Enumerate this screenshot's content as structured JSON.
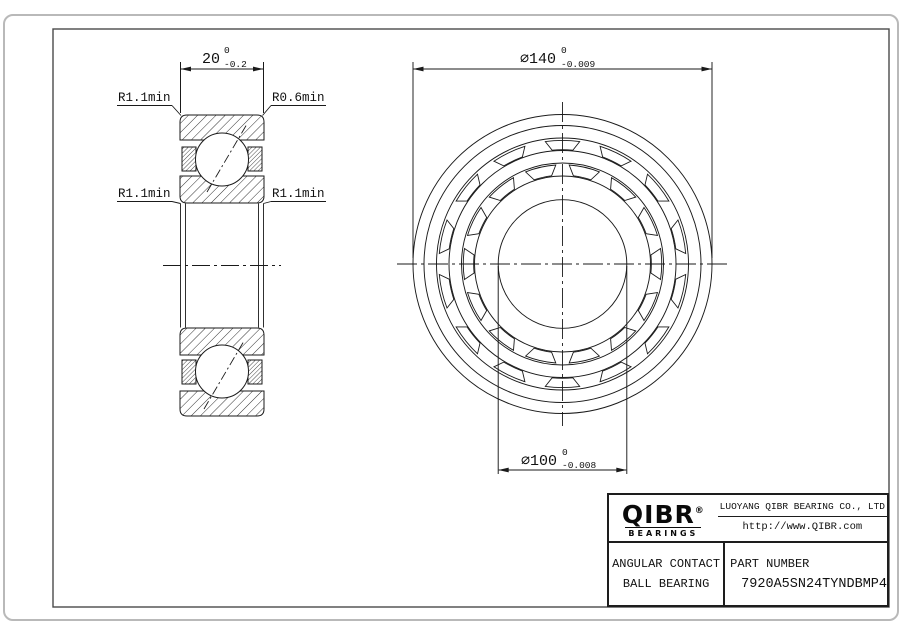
{
  "drawing": {
    "dim_width": {
      "value": "20",
      "tol_upper": "0",
      "tol_lower": "-0.2"
    },
    "dim_outer": {
      "value": "∅140",
      "tol_upper": "0",
      "tol_lower": "-0.009"
    },
    "dim_bore": {
      "value": "∅100",
      "tol_upper": "0",
      "tol_lower": "-0.008"
    },
    "radius_labels": {
      "top_left": "R1.1min",
      "top_right": "R0.6min",
      "bottom_left": "R1.1min",
      "bottom_right": "R1.1min"
    }
  },
  "title_block": {
    "logo": {
      "text": "QIBR",
      "registered": "®",
      "subtext": "BEARINGS"
    },
    "company": "LUOYANG QIBR BEARING CO., LTD",
    "website": "http://www.QIBR.com",
    "product_type_line1": "ANGULAR CONTACT",
    "product_type_line2": "BALL BEARING",
    "part_number_label": "PART NUMBER",
    "part_number": "7920A5SN24TYNDBMP4"
  },
  "colors": {
    "line": "#1a1a1a",
    "frame": "#4a4a4a",
    "border": "#b9b9b9"
  }
}
